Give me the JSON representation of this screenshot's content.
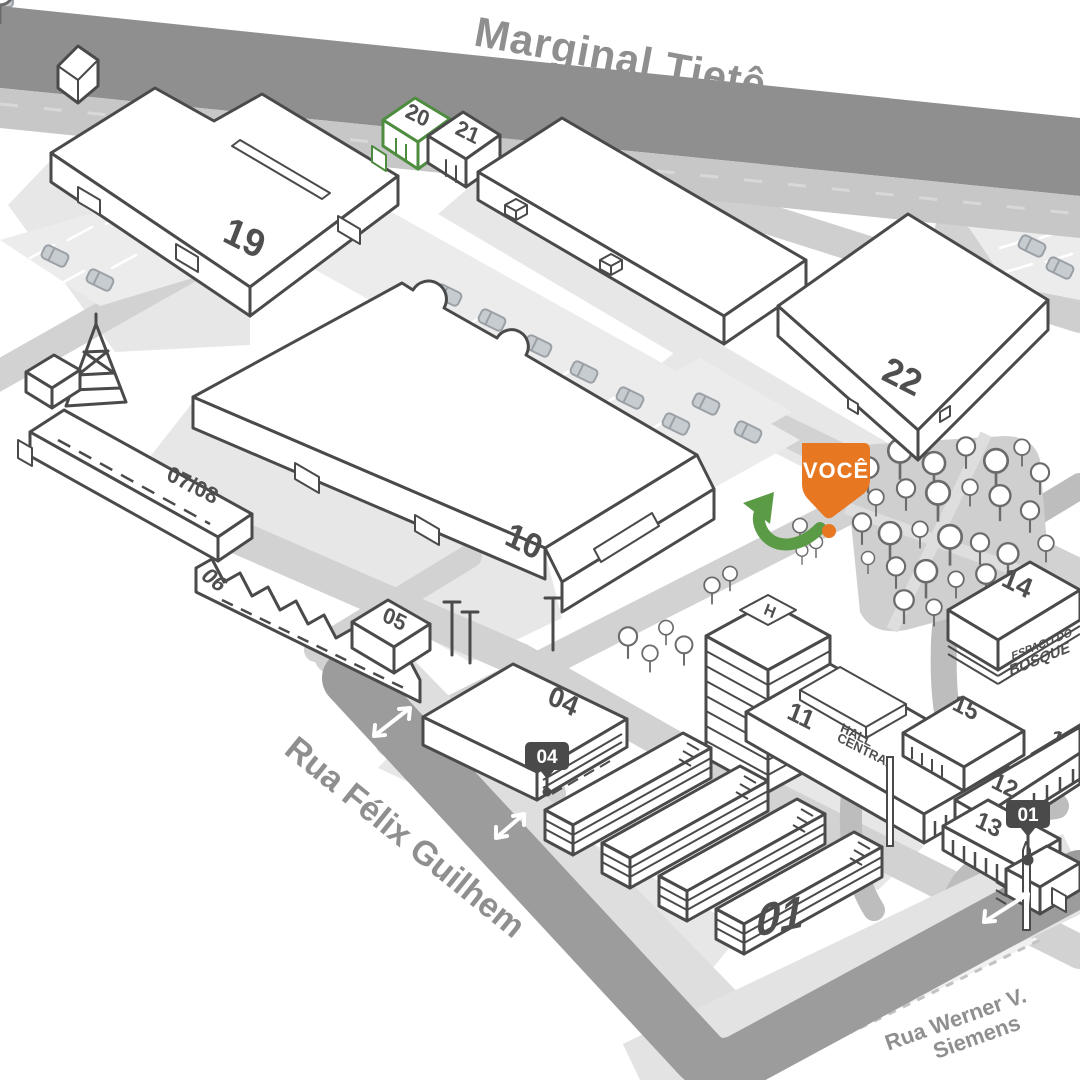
{
  "map": {
    "streets": {
      "marginal": "Marginal Tietê",
      "felix": "Rua Félix Guilhem",
      "werner_line1": "Rua Werner V.",
      "werner_line2": "Siemens"
    },
    "you_marker": {
      "label": "VOCÊ"
    },
    "pins": {
      "pin04": "04",
      "pin01": "01"
    },
    "buildings": {
      "b19": "19",
      "b20": "20",
      "b21": "21",
      "b22": "22",
      "b10": "10",
      "b0708": "07/08",
      "b06": "06",
      "b05": "05",
      "b04": "04",
      "b11": "11",
      "b01": "01",
      "b12": "12",
      "b13": "13",
      "b14": "14",
      "b15": "15",
      "b16": "16",
      "hall_line1": "HALL",
      "hall_line2": "CENTRAL",
      "espaco_line1": "ESPAÇO DO",
      "espaco_line2": "BOSQUE",
      "helipad": "H"
    },
    "colors": {
      "orange": "#E87722",
      "green": "#4E8C3F",
      "green_arrow": "#5C9B46",
      "road_dark": "#8F8F8F",
      "road_light": "#D3D3D3"
    }
  }
}
